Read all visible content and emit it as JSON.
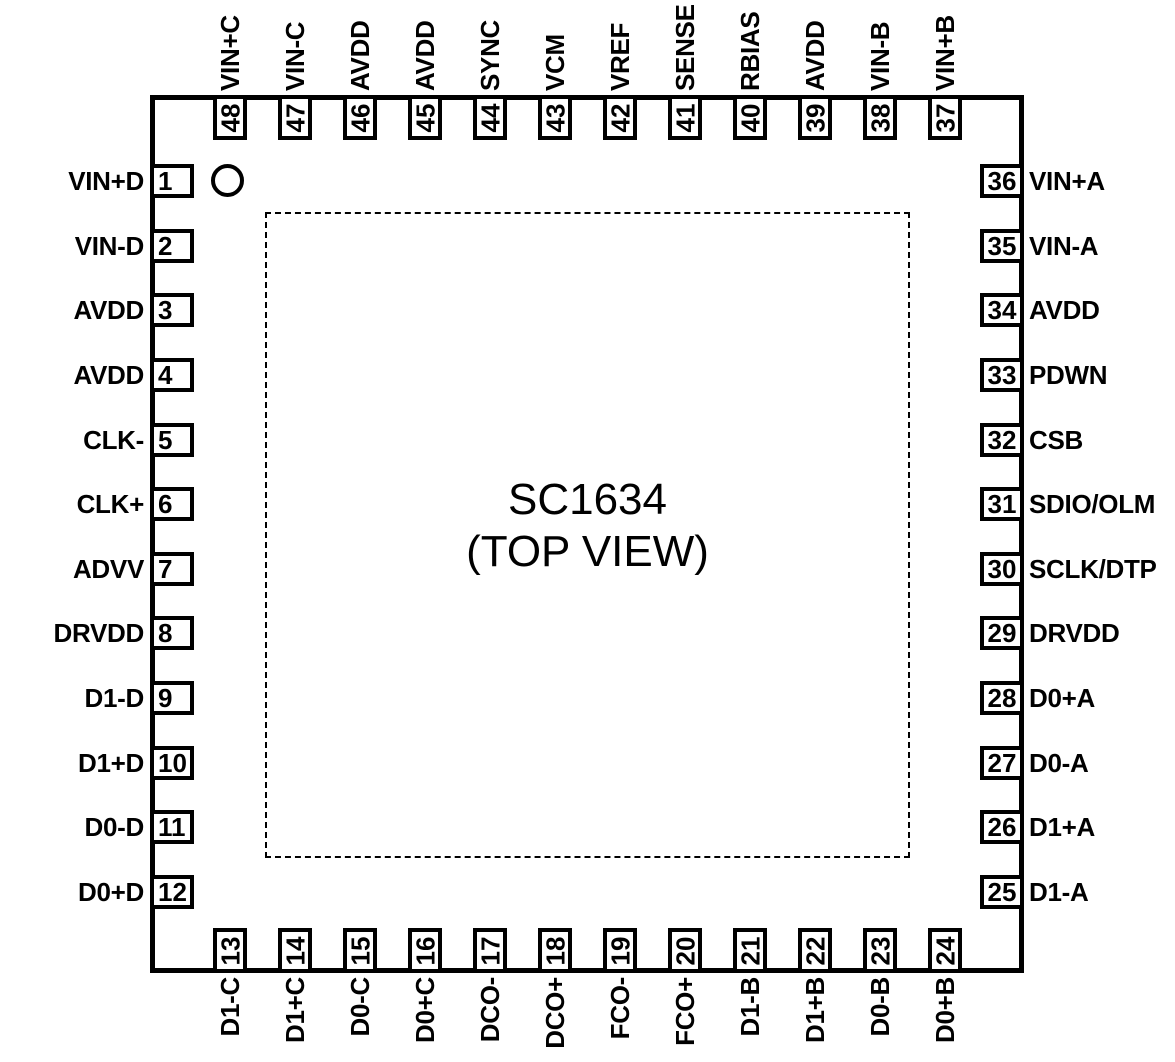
{
  "chip": {
    "title": "SC1634",
    "subtitle": "(TOP VIEW)"
  },
  "colors": {
    "line": "#000000",
    "background": "#ffffff"
  },
  "pins": {
    "left": [
      {
        "num": "1",
        "label": "VIN+D"
      },
      {
        "num": "2",
        "label": "VIN-D"
      },
      {
        "num": "3",
        "label": "AVDD"
      },
      {
        "num": "4",
        "label": "AVDD"
      },
      {
        "num": "5",
        "label": "CLK-"
      },
      {
        "num": "6",
        "label": "CLK+"
      },
      {
        "num": "7",
        "label": "ADVV"
      },
      {
        "num": "8",
        "label": "DRVDD"
      },
      {
        "num": "9",
        "label": "D1-D"
      },
      {
        "num": "10",
        "label": "D1+D"
      },
      {
        "num": "11",
        "label": "D0-D"
      },
      {
        "num": "12",
        "label": "D0+D"
      }
    ],
    "bottom": [
      {
        "num": "13",
        "label": "D1-C"
      },
      {
        "num": "14",
        "label": "D1+C"
      },
      {
        "num": "15",
        "label": "D0-C"
      },
      {
        "num": "16",
        "label": "D0+C"
      },
      {
        "num": "17",
        "label": "DCO-"
      },
      {
        "num": "18",
        "label": "DCO+"
      },
      {
        "num": "19",
        "label": "FCO-"
      },
      {
        "num": "20",
        "label": "FCO+"
      },
      {
        "num": "21",
        "label": "D1-B"
      },
      {
        "num": "22",
        "label": "D1+B"
      },
      {
        "num": "23",
        "label": "D0-B"
      },
      {
        "num": "24",
        "label": "D0+B"
      }
    ],
    "right": [
      {
        "num": "36",
        "label": "VIN+A"
      },
      {
        "num": "35",
        "label": "VIN-A"
      },
      {
        "num": "34",
        "label": "AVDD"
      },
      {
        "num": "33",
        "label": "PDWN"
      },
      {
        "num": "32",
        "label": "CSB"
      },
      {
        "num": "31",
        "label": "SDIO/OLM"
      },
      {
        "num": "30",
        "label": "SCLK/DTP"
      },
      {
        "num": "29",
        "label": "DRVDD"
      },
      {
        "num": "28",
        "label": "D0+A"
      },
      {
        "num": "27",
        "label": "D0-A"
      },
      {
        "num": "26",
        "label": "D1+A"
      },
      {
        "num": "25",
        "label": "D1-A"
      }
    ],
    "top": [
      {
        "num": "48",
        "label": "VIN+C"
      },
      {
        "num": "47",
        "label": "VIN-C"
      },
      {
        "num": "46",
        "label": "AVDD"
      },
      {
        "num": "45",
        "label": "AVDD"
      },
      {
        "num": "44",
        "label": "SYNC"
      },
      {
        "num": "43",
        "label": "VCM"
      },
      {
        "num": "42",
        "label": "VREF"
      },
      {
        "num": "41",
        "label": "SENSE"
      },
      {
        "num": "40",
        "label": "RBIAS"
      },
      {
        "num": "39",
        "label": "AVDD"
      },
      {
        "num": "38",
        "label": "VIN-B"
      },
      {
        "num": "37",
        "label": "VIN+B"
      }
    ]
  }
}
